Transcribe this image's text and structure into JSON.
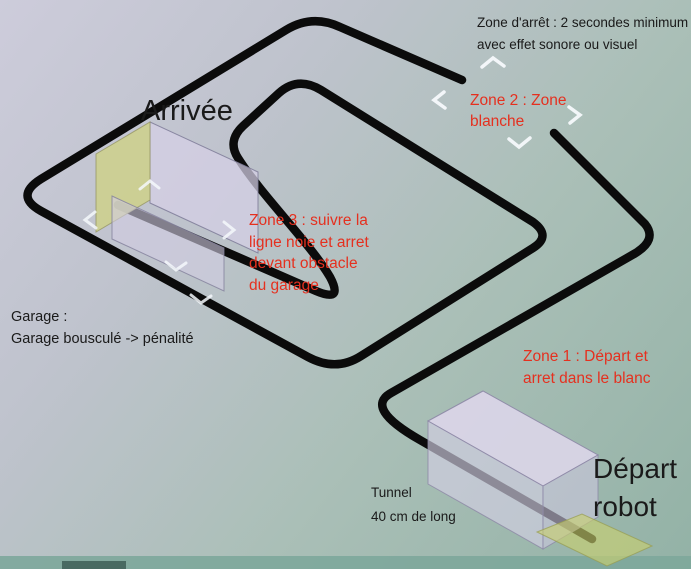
{
  "diagram": {
    "labels": {
      "stop_zone": "Zone d'arrêt : 2 secondes minimum\navec effet sonore ou visuel",
      "zone2": "Zone 2 : Zone\nblanche",
      "arrivee": "Arrivée",
      "zone3": "Zone 3 : suivre la\nligne noie et arret\ndevant obstacle\ndu garage",
      "garage": "Garage :\nGarage bousculé -> pénalité",
      "zone1": "Zone 1 : Départ et\narret dans le blanc",
      "tunnel": "Tunnel\n40 cm de long",
      "depart": "Départ\nrobot"
    },
    "colors": {
      "background_top_left": "#cdccdb",
      "background_bottom_right": "#93b2a6",
      "track": "#0b0b0b",
      "red_label": "#e5301f",
      "black_label": "#1a1a1a",
      "garage_wall_lavender": "#d6d0e6",
      "garage_gable_yellow": "#cdd08c",
      "start_pad_yellow": "#cacd6e",
      "zone_marker_white": "#f4f8fc",
      "bottom_band_teal": "#7da79b"
    }
  }
}
